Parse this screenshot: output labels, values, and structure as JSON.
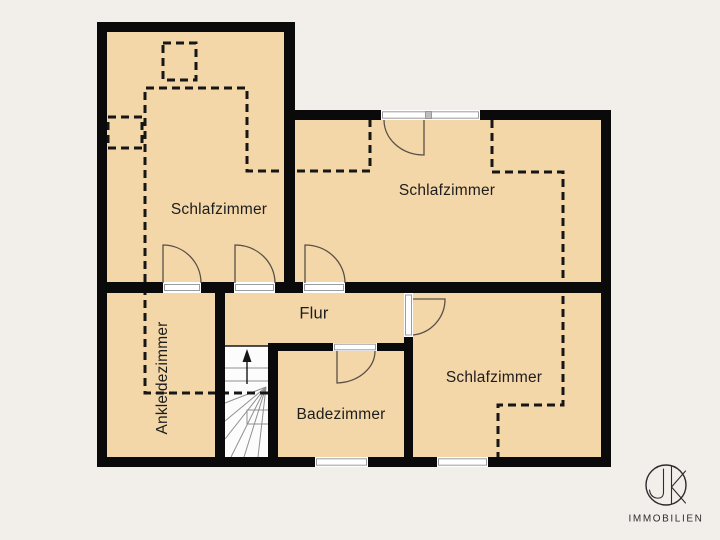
{
  "plan": {
    "type": "floor-plan",
    "rooms": [
      {
        "id": "bedroom-left",
        "label": "Schlafzimmer"
      },
      {
        "id": "bedroom-top-right",
        "label": "Schlafzimmer"
      },
      {
        "id": "bedroom-bottom-right",
        "label": "Schlafzimmer"
      },
      {
        "id": "hallway",
        "label": "Flur"
      },
      {
        "id": "bathroom",
        "label": "Badezimmer"
      },
      {
        "id": "dressing-room",
        "label": "Ankleidezimmer"
      }
    ],
    "features": [
      "staircase-with-winders",
      "up-arrow",
      "roof-slope-dashed-lines",
      "3-windows",
      "6-door-swings"
    ]
  },
  "logo": {
    "monogram": "JK",
    "company": "IMMOBILIEN"
  },
  "colors": {
    "background": "#f2eeea",
    "floor": "#f4d7a8",
    "wall": "#0a0a0a",
    "dash": "#161616",
    "arc": "#5a5047",
    "frame": "#9c9c9c",
    "text": "#1d1d1d",
    "logo": "#2d2d2d"
  }
}
